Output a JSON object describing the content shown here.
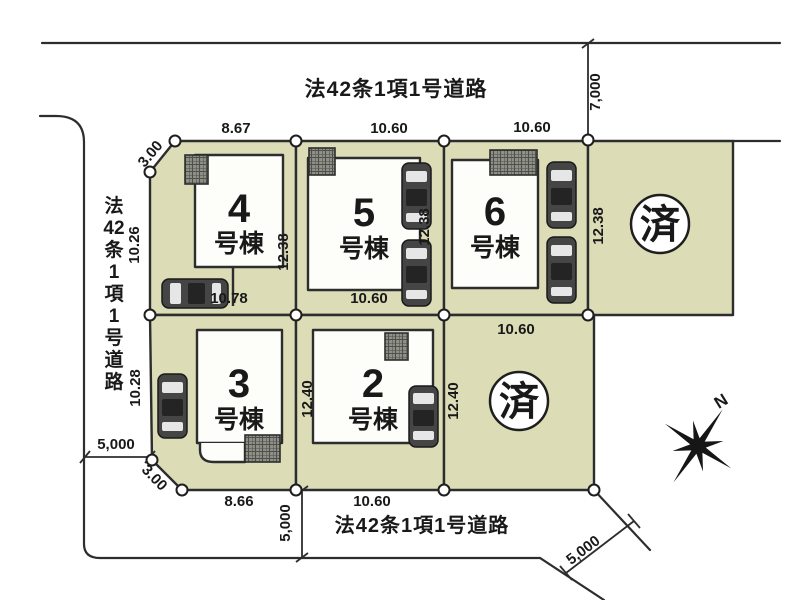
{
  "road": {
    "top_label": "法42条1項1号道路",
    "bottom_label": "法42条1項1号道路",
    "left_chars": [
      "法",
      "42",
      "条",
      "1",
      "項",
      "1",
      "号",
      "道",
      "路"
    ],
    "width_top": "7,000",
    "width_left": "5,000",
    "width_bottom": "5,000",
    "width_corner": "5,000"
  },
  "lots": [
    {
      "number": "4",
      "suffix": "号棟",
      "dim_top": "8.67",
      "dim_left": "10.26",
      "dim_right": "12.38",
      "dim_bottom": "10.78",
      "dim_corner": "3.00"
    },
    {
      "number": "5",
      "suffix": "号棟",
      "dim_top": "10.60",
      "dim_right": "12.38",
      "dim_bottom": "10.60"
    },
    {
      "number": "6",
      "suffix": "号棟",
      "dim_top": "10.60",
      "dim_right": "12.38",
      "dim_bottom": "10.60"
    },
    {
      "number": "3",
      "suffix": "号棟",
      "dim_left": "10.28",
      "dim_bottom": "8.66",
      "dim_corner": "3.00"
    },
    {
      "number": "2",
      "suffix": "号棟",
      "dim_left": "12.40",
      "dim_bottom": "10.60"
    }
  ],
  "sold_lots": [
    {
      "status": "済"
    },
    {
      "status": "済",
      "dim_left": "12.40"
    }
  ],
  "compass": {
    "north": "N"
  },
  "colors": {
    "lot_fill": "#dcdcb6",
    "line": "#2d2d2d",
    "building_fill": "#fdfdfa"
  }
}
